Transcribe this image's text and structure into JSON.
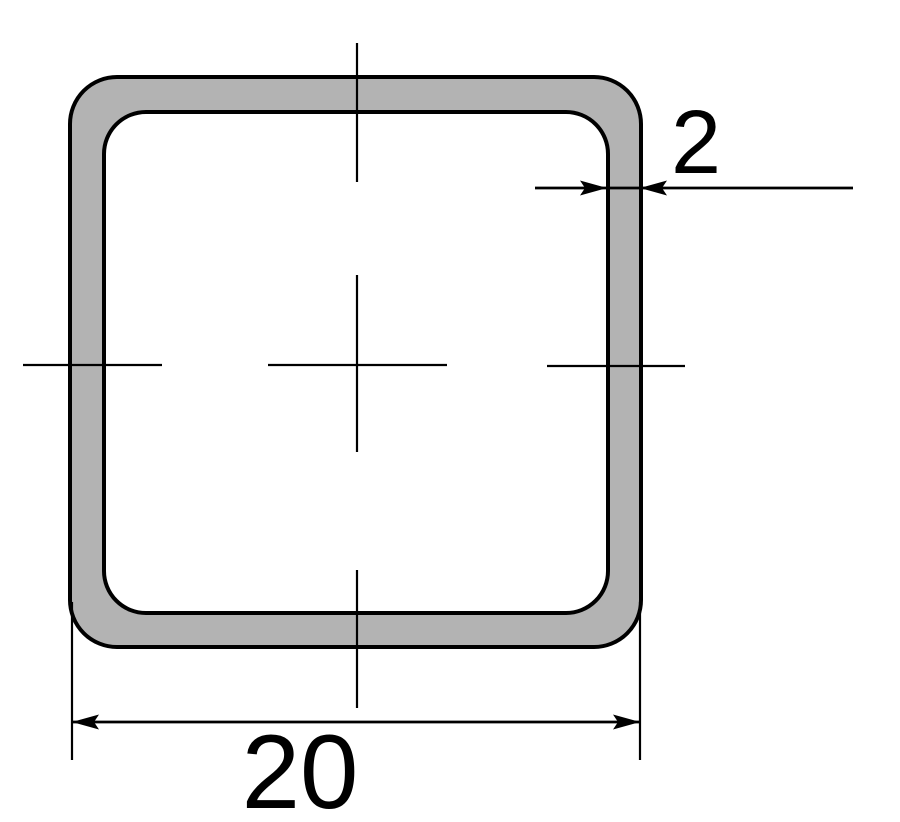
{
  "diagram": {
    "background_color": "#ffffff",
    "line_color": "#000000",
    "tube": {
      "fill_color": "#b3b3b3",
      "hollow_color": "#ffffff",
      "outline_color": "#000000"
    },
    "labels": {
      "outer_size": "20",
      "wall_thickness": "2"
    }
  }
}
